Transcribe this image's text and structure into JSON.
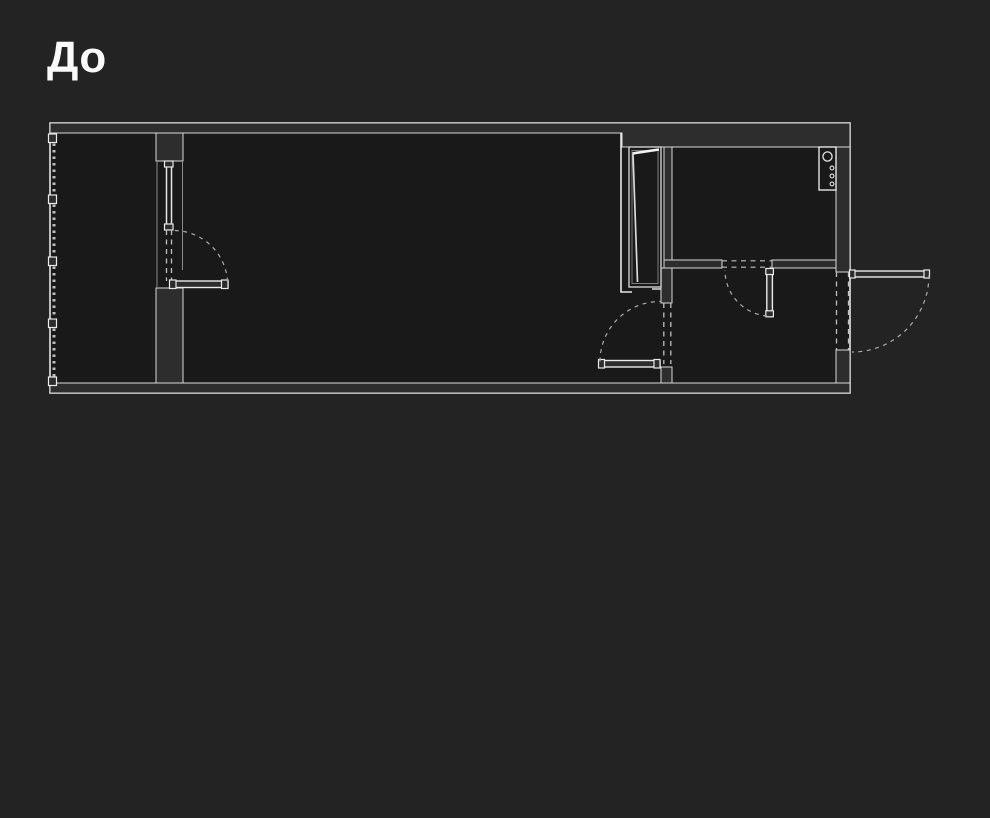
{
  "title": "До",
  "colors": {
    "background": "#232323",
    "plan_floor": "#191919",
    "wall_fill": "#2d2d2d",
    "line_bright": "#e6e6e6",
    "line_dim": "#8a8a8a",
    "line_dashed": "#c0c0c0",
    "title_color": "#fafafa"
  },
  "plan": {
    "kind": "apartment-floor-plan-before-renovation",
    "elements": [
      "outer-walls",
      "balcony-with-glazed-wall",
      "balcony-window",
      "balcony-door-open-into-room",
      "main-room",
      "vent-shaft-niche",
      "bathroom",
      "water-heater-fixture",
      "bathroom-door-open-into-hallway",
      "hallway",
      "interior-door-open-into-room",
      "entrance-door-open-outward"
    ]
  }
}
